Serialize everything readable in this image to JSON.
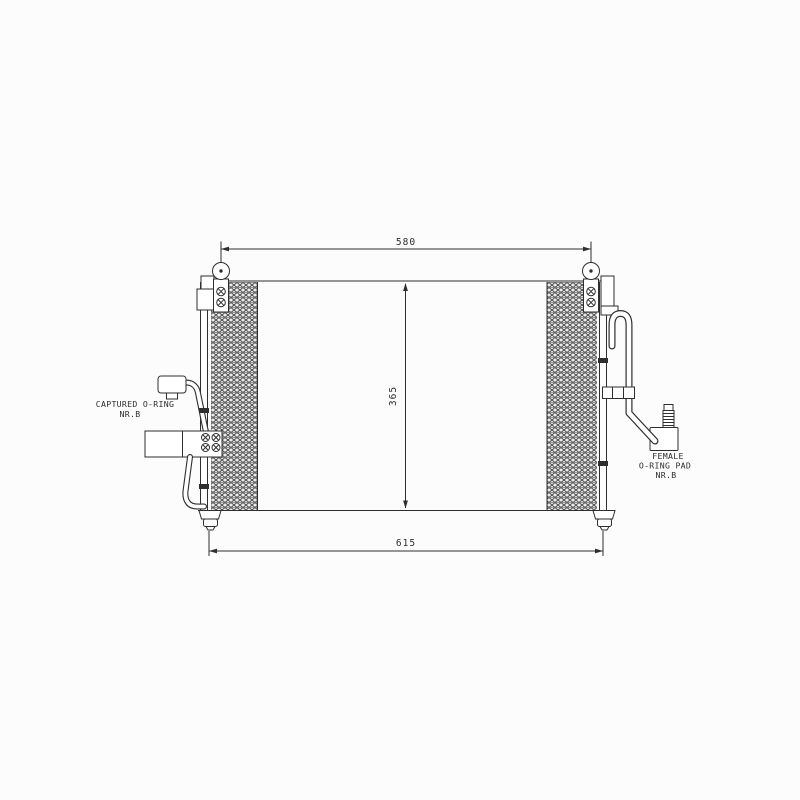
{
  "drawing": {
    "subject": "air-conditioning condenser technical drawing, front view with dimensions",
    "background": "#fcfcfc",
    "line_color": "#2e2e2e",
    "dimensions": {
      "top_width": "580",
      "core_height": "365",
      "overall_width": "615"
    },
    "labels": {
      "left_fitting_line1": "CAPTURED O-RING",
      "left_fitting_line2": "NR.B",
      "right_fitting_line1": "FEMALE",
      "right_fitting_line2": "O-RING PAD",
      "right_fitting_line3": "NR.B"
    }
  }
}
